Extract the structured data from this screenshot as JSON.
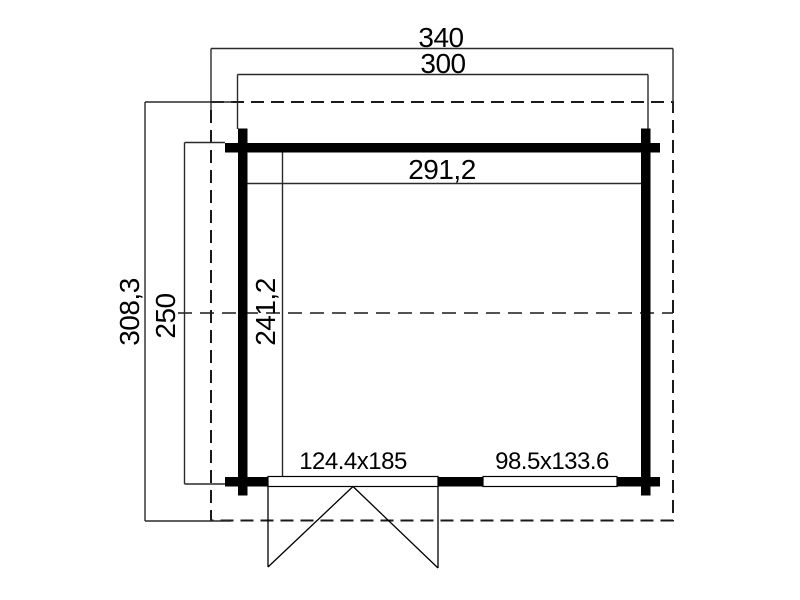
{
  "drawing": {
    "type": "garden-house-floor-plan",
    "background_color": "#ffffff",
    "wall_color": "#000000",
    "line_color": "#1a1a1a",
    "text_color": "#000000"
  },
  "dimensions": {
    "roof_outer_width": "340",
    "wall_outer_width": "300",
    "interior_width": "291,2",
    "roof_outer_depth": "308,3",
    "wall_outer_depth": "250",
    "interior_depth": "241,2"
  },
  "openings": {
    "door_size_label": "124.4x185",
    "window_size_label": "98.5x133.6"
  }
}
